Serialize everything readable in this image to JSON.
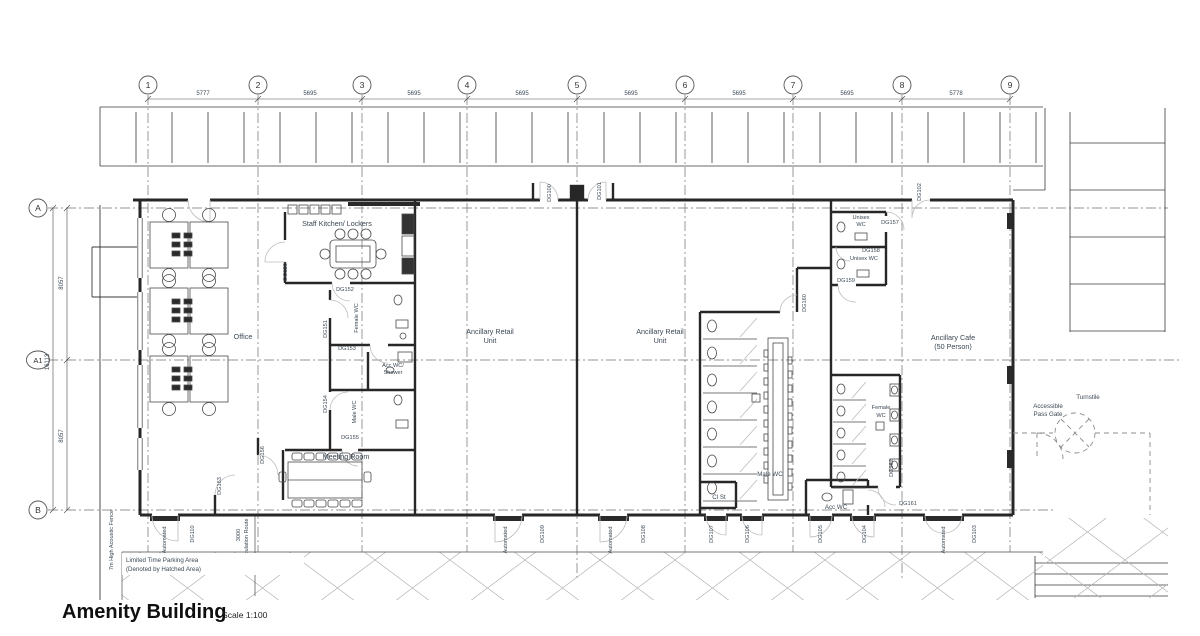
{
  "title": {
    "name": "Amenity Building",
    "scale": "Scale 1:100"
  },
  "grid": {
    "cols": [
      "1",
      "2",
      "3",
      "4",
      "5",
      "6",
      "7",
      "8",
      "9"
    ],
    "col_dims": [
      "5777",
      "5695",
      "5695",
      "5695",
      "5695",
      "5695",
      "5695",
      "5778"
    ],
    "rows": [
      "A",
      "A1",
      "B"
    ],
    "row_dim": "8057",
    "row_total": "16113"
  },
  "rooms": {
    "office": "Office",
    "staff_kitchen": "Staff Kitchen/ Lockers",
    "female_wc_vert": "Female WC",
    "male_wc_vert": "Male WC",
    "acc_wc_shower_1": "Acc WC/",
    "acc_wc_shower_2": "Shower",
    "meeting": "Meeting Room",
    "retail_1": "Ancillary Retail",
    "retail_2": "Unit",
    "male_wc": "Male WC",
    "cl_st": "Cl St",
    "acc_wc": "Acc WC",
    "unisex_1": "Unisex",
    "unisex_2": "WC",
    "unisex_single": "Unisex WC",
    "female_1": "Female",
    "female_2": "WC",
    "cafe_1": "Ancillary Cafe",
    "cafe_2": "(50 Person)"
  },
  "doors": {
    "dg100": "DG100",
    "dg101": "DG101",
    "dg102": "DG102",
    "dg103": "DG103",
    "dg104": "DG104",
    "dg105": "DG105",
    "dg106": "DG106",
    "dg107": "DG107",
    "dg108": "DG108",
    "dg109": "DG109",
    "dg110": "DG110",
    "dg150": "DG150",
    "dg151": "DG151",
    "dg152": "DG152",
    "dg153": "DG153",
    "dg154": "DG154",
    "dg155": "DG155",
    "dg156": "DG156",
    "dg157": "DG157",
    "dg158": "DG158",
    "dg159": "DG159",
    "dg160": "DG160",
    "dg161": "DG161",
    "dg162": "DG162",
    "dg163": "DG163"
  },
  "site": {
    "automated": "Automated",
    "circulation_dim": "3000",
    "circulation": "Circulation Route",
    "parking_1": "Limited Time Parking Area",
    "parking_2": "(Denoted by Hatched Area)",
    "fence": "7m High Acoustic Fence",
    "turnstile": "Turnstile",
    "gate_1": "Accessible",
    "gate_2": "Pass Gate"
  },
  "colors": {
    "wall": "#272727",
    "text": "#3b4854",
    "arc": "#bcbcbc",
    "grid": "#707070",
    "hatch": "#b0b0b0"
  }
}
